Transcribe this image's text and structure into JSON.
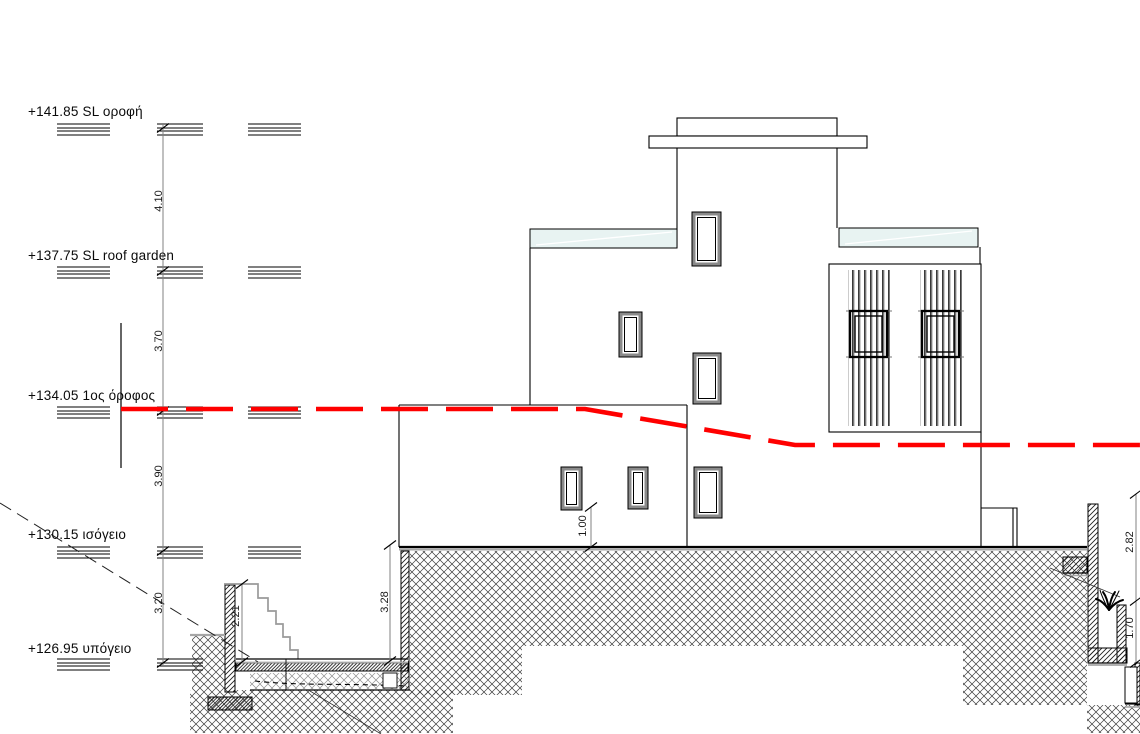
{
  "drawing": {
    "type": "architectural-section-elevation",
    "levels": [
      {
        "label": "+141.85 SL οροφή",
        "elevation": "+141.85",
        "name": "SL οροφή"
      },
      {
        "label": "+137.75 SL roof garden",
        "elevation": "+137.75",
        "name": "SL roof garden"
      },
      {
        "label": "+134.05 1ος όροφος",
        "elevation": "+134.05",
        "name": "1ος όροφος"
      },
      {
        "label": "+130.15 ισόγειο",
        "elevation": "+130.15",
        "name": "ισόγειο"
      },
      {
        "label": "+126.95 υπόγειο",
        "elevation": "+126.95",
        "name": "υπόγειο"
      }
    ],
    "dimensions": {
      "roof_to_roofgarden": "4.10",
      "roofgarden_to_first": "3.70",
      "first_to_ground": "3.90",
      "ground_to_basement": "3.20",
      "stair_height": "2.21",
      "basement_depth": "3.28",
      "sill_height": "1.00",
      "right_wall_upper": "2.82",
      "right_wall_lower": "1.70"
    },
    "colors": {
      "grade_line": "#ff0000",
      "slab_fill": "#e8f3f2",
      "dim_line": "#808080"
    }
  }
}
